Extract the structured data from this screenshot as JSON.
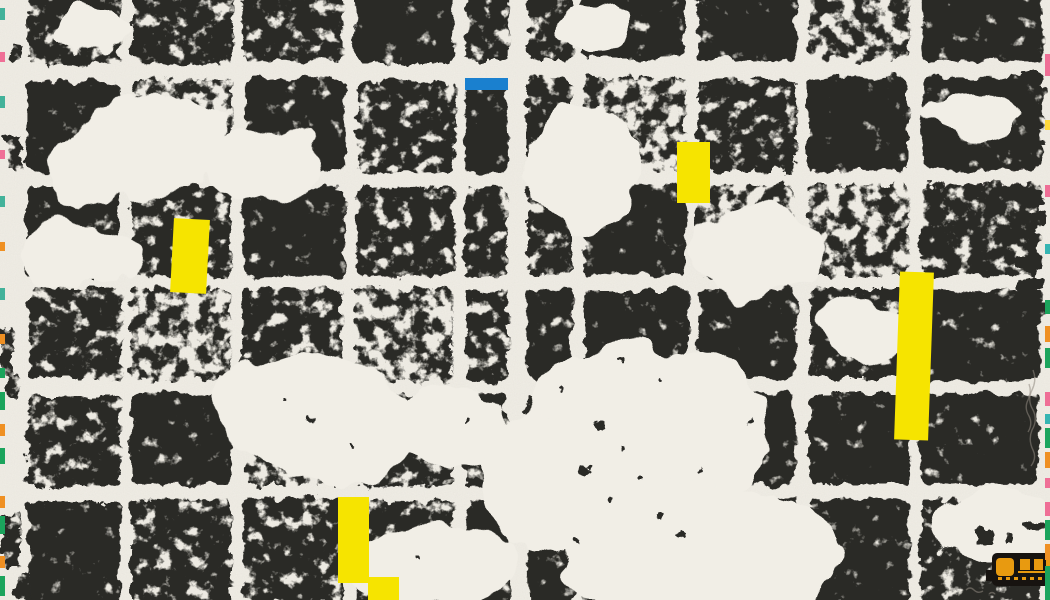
{
  "artwork": {
    "description": "photograph of an abstract monoprint: two distressed black ink grid panels on cream paper with yellow tape marks, one blue tape mark, colored registration dashes on the deckle edges, and a small black-and-amber glyph in the lower right corner",
    "colors": {
      "paper": "#f1eee6",
      "ink": "#2b2a28",
      "tape_yellow": "#f6e400",
      "mark_blue": "#1a80cf",
      "mark_amber": "#e89a10",
      "train_black": "#171310",
      "edge_teal": "#43b29a",
      "edge_green": "#1ba45c",
      "edge_pink": "#ef6f96",
      "edge_orange": "#ef9023",
      "edge_cyan": "#35b5b2",
      "edge_yellow": "#ffd93b",
      "pencil": "#8f897f"
    },
    "panels": [
      {
        "name": "left-panel",
        "cols": [
          28,
          132,
          244,
          356,
          466
        ],
        "colw": [
          92,
          100,
          100,
          98,
          42
        ],
        "rows": [
          -45,
          80,
          186,
          290,
          395,
          500
        ],
        "rowh": [
          107,
          92,
          90,
          91,
          91,
          105
        ]
      },
      {
        "name": "right-panel",
        "cols": [
          528,
          583,
          698,
          808,
          921
        ],
        "colw": [
          45,
          103,
          98,
          101,
          119
        ],
        "rows": [
          -45,
          78,
          184,
          289,
          394,
          499
        ],
        "rowh": [
          105,
          92,
          91,
          91,
          91,
          105
        ]
      }
    ],
    "voids": [
      {
        "cx": 140,
        "cy": 150,
        "rx": 95,
        "ry": 52,
        "rot": -10
      },
      {
        "cx": 270,
        "cy": 165,
        "rx": 55,
        "ry": 38,
        "rot": 6
      },
      {
        "cx": 90,
        "cy": 30,
        "rx": 35,
        "ry": 20,
        "rot": 0
      },
      {
        "cx": 80,
        "cy": 255,
        "rx": 60,
        "ry": 35,
        "rot": 5
      },
      {
        "cx": 320,
        "cy": 420,
        "rx": 105,
        "ry": 62,
        "rot": 8
      },
      {
        "cx": 455,
        "cy": 430,
        "rx": 55,
        "ry": 45,
        "rot": 0
      },
      {
        "cx": 430,
        "cy": 565,
        "rx": 85,
        "ry": 45,
        "rot": -5
      },
      {
        "cx": 590,
        "cy": 30,
        "rx": 40,
        "ry": 22,
        "rot": 0
      },
      {
        "cx": 585,
        "cy": 165,
        "rx": 55,
        "ry": 62,
        "rot": 0
      },
      {
        "cx": 755,
        "cy": 255,
        "rx": 68,
        "ry": 45,
        "rot": -8
      },
      {
        "cx": 645,
        "cy": 430,
        "rx": 125,
        "ry": 85,
        "rot": 0
      },
      {
        "cx": 700,
        "cy": 555,
        "rx": 140,
        "ry": 70,
        "rot": 0
      },
      {
        "cx": 545,
        "cy": 480,
        "rx": 60,
        "ry": 70,
        "rot": 0
      },
      {
        "cx": 860,
        "cy": 330,
        "rx": 48,
        "ry": 32,
        "rot": 10
      },
      {
        "cx": 975,
        "cy": 115,
        "rx": 40,
        "ry": 24,
        "rot": 0
      },
      {
        "cx": 995,
        "cy": 525,
        "rx": 55,
        "ry": 40,
        "rot": 0
      }
    ],
    "speckles": [
      [
        600,
        425,
        4
      ],
      [
        622,
        448,
        3
      ],
      [
        585,
        470,
        5
      ],
      [
        640,
        478,
        3
      ],
      [
        560,
        390,
        2
      ],
      [
        610,
        500,
        3
      ],
      [
        660,
        515,
        4
      ],
      [
        700,
        470,
        2
      ],
      [
        575,
        540,
        3
      ],
      [
        545,
        350,
        2
      ],
      [
        310,
        420,
        3
      ],
      [
        350,
        445,
        2
      ],
      [
        285,
        400,
        2
      ],
      [
        420,
        560,
        2
      ],
      [
        468,
        420,
        3
      ],
      [
        905,
        470,
        3
      ],
      [
        660,
        380,
        2
      ],
      [
        750,
        420,
        3
      ],
      [
        620,
        360,
        2
      ],
      [
        680,
        535,
        3
      ]
    ],
    "margin_blobs": [
      {
        "x": 6,
        "y": 136,
        "w": 17,
        "h": 34
      },
      {
        "x": 0,
        "y": 326,
        "w": 13,
        "h": 46
      },
      {
        "x": 7,
        "y": 372,
        "w": 11,
        "h": 26
      },
      {
        "x": 2,
        "y": 514,
        "w": 18,
        "h": 52
      },
      {
        "x": 12,
        "y": 44,
        "w": 11,
        "h": 16
      },
      {
        "x": 16,
        "y": 574,
        "w": 14,
        "h": 26
      }
    ],
    "margin_dashes": [
      {
        "x": 1022,
        "y": 72,
        "w": 24,
        "h": 10
      },
      {
        "x": 1024,
        "y": 86,
        "w": 22,
        "h": 8
      },
      {
        "x": 1030,
        "y": 140,
        "w": 15,
        "h": 6
      },
      {
        "x": 1020,
        "y": 190,
        "w": 25,
        "h": 15
      },
      {
        "x": 1022,
        "y": 212,
        "w": 23,
        "h": 12
      },
      {
        "x": 1015,
        "y": 256,
        "w": 28,
        "h": 14
      },
      {
        "x": 1017,
        "y": 278,
        "w": 27,
        "h": 13
      },
      {
        "x": 1023,
        "y": 304,
        "w": 22,
        "h": 10
      },
      {
        "x": 1028,
        "y": 360,
        "w": 14,
        "h": 6
      },
      {
        "x": 1026,
        "y": 520,
        "w": 18,
        "h": 8
      },
      {
        "x": 978,
        "y": 530,
        "w": 16,
        "h": 14
      },
      {
        "x": 1004,
        "y": 532,
        "w": 8,
        "h": 12
      }
    ],
    "tapes": [
      {
        "x": 172,
        "y": 219,
        "w": 36,
        "h": 74,
        "rot": 3
      },
      {
        "x": 677,
        "y": 142,
        "w": 33,
        "h": 61,
        "rot": 0
      },
      {
        "x": 897,
        "y": 272,
        "w": 34,
        "h": 168,
        "rot": 2
      },
      {
        "x": 338,
        "y": 497,
        "w": 31,
        "h": 86,
        "rot": 0
      },
      {
        "x": 368,
        "y": 577,
        "w": 31,
        "h": 23,
        "rot": 0
      }
    ],
    "blue_mark": {
      "x": 465,
      "y": 78,
      "w": 43,
      "h": 12
    },
    "train_mark": {
      "body": {
        "x": 992,
        "y": 553,
        "w": 58,
        "h": 33
      },
      "foot": {
        "x": 986,
        "y": 570,
        "w": 10,
        "h": 11
      },
      "cab": {
        "x": 996,
        "y": 558,
        "w": 18,
        "h": 18
      },
      "rail": {
        "x": 1018,
        "y": 571,
        "w": 32,
        "h": 2
      },
      "windows": [
        [
          1020,
          559,
          10,
          11
        ],
        [
          1034,
          559,
          9,
          11
        ],
        [
          1046,
          559,
          4,
          11
        ]
      ],
      "dots": [
        [
          998,
          577
        ],
        [
          1006,
          577
        ],
        [
          1014,
          577
        ],
        [
          1022,
          577
        ],
        [
          1030,
          577
        ],
        [
          1038,
          577
        ]
      ]
    },
    "edge_left": {
      "x": 0,
      "w": 5,
      "segments": [
        [
          8,
          12,
          "edge_teal"
        ],
        [
          52,
          10,
          "edge_pink"
        ],
        [
          96,
          12,
          "edge_teal"
        ],
        [
          150,
          9,
          "edge_pink"
        ],
        [
          196,
          11,
          "edge_teal"
        ],
        [
          242,
          9,
          "edge_orange"
        ],
        [
          288,
          12,
          "edge_teal"
        ],
        [
          334,
          10,
          "edge_orange"
        ],
        [
          368,
          10,
          "edge_green"
        ],
        [
          392,
          18,
          "edge_green"
        ],
        [
          424,
          12,
          "edge_orange"
        ],
        [
          448,
          16,
          "edge_green"
        ],
        [
          496,
          12,
          "edge_orange"
        ],
        [
          516,
          18,
          "edge_green"
        ],
        [
          556,
          12,
          "edge_orange"
        ],
        [
          576,
          20,
          "edge_green"
        ]
      ]
    },
    "edge_right": {
      "x": 1045,
      "w": 5,
      "segments": [
        [
          54,
          22,
          "edge_pink"
        ],
        [
          120,
          10,
          "edge_yellow"
        ],
        [
          185,
          12,
          "edge_pink"
        ],
        [
          244,
          10,
          "edge_cyan"
        ],
        [
          300,
          14,
          "edge_green"
        ],
        [
          326,
          16,
          "edge_orange"
        ],
        [
          348,
          20,
          "edge_green"
        ],
        [
          392,
          14,
          "edge_pink"
        ],
        [
          414,
          10,
          "edge_cyan"
        ],
        [
          428,
          20,
          "edge_green"
        ],
        [
          452,
          16,
          "edge_orange"
        ],
        [
          478,
          10,
          "edge_pink"
        ],
        [
          502,
          14,
          "edge_pink"
        ],
        [
          520,
          20,
          "edge_green"
        ],
        [
          544,
          16,
          "edge_orange"
        ],
        [
          566,
          34,
          "edge_green"
        ]
      ]
    },
    "pencil_scribbles": [
      {
        "d": "M 1033 370 q 4 10 -1 20 q -5 10 1 20 q 5 10 -1 20 q -4 10 1 20 q 4 8 -2 16"
      },
      {
        "d": "M 1029 384 q 3 8 -1 16 q -4 8 1 16 q 4 8 -1 16"
      },
      {
        "d": "M 966 590 q 4 -4 8 0 q 4 4 9 1 m 6 3 q 3 -3 6 0"
      }
    ]
  }
}
